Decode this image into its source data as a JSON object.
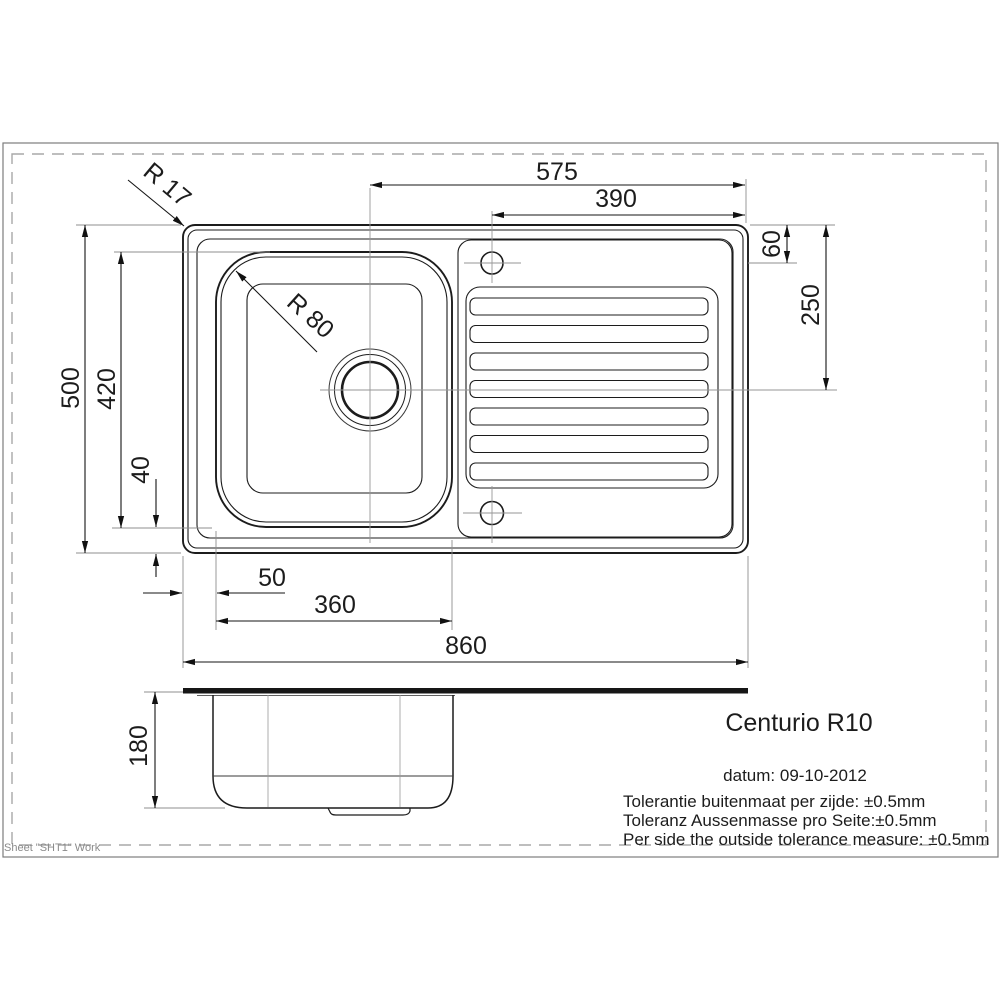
{
  "title_block": {
    "product_name": "Centurio R10",
    "date": "datum: 09-10-2012",
    "tolerance_nl": "Tolerantie buitenmaat per zijde: ±0.5mm",
    "tolerance_de": "Toleranz Aussenmasse pro Seite:±0.5mm",
    "tolerance_en": "Per side the outside tolerance measure: ±0.5mm"
  },
  "sheet": {
    "label": "Sheet \"SHT1\" Work"
  },
  "dimensions": {
    "drain_center_to_right_edge": "575",
    "tap_hole_to_right_edge": "390",
    "tap_hole_offset_from_top": "60",
    "top_edge_to_drain_center": "250",
    "overall_depth": "500",
    "bowl_outer_depth": "420",
    "bowl_to_bottom_edge": "40",
    "left_edge_to_bowl": "50",
    "bowl_outer_width": "360",
    "overall_width": "860",
    "overall_height": "180",
    "rim_corner_radius": "R 17",
    "bowl_corner_radius": "R 80"
  },
  "colors": {
    "line": "#1c1c1c",
    "centerline": "#969696",
    "extension": "#8f8f8f",
    "frame": "#7d7d7d",
    "dashed_border": "#a8a8a8"
  }
}
